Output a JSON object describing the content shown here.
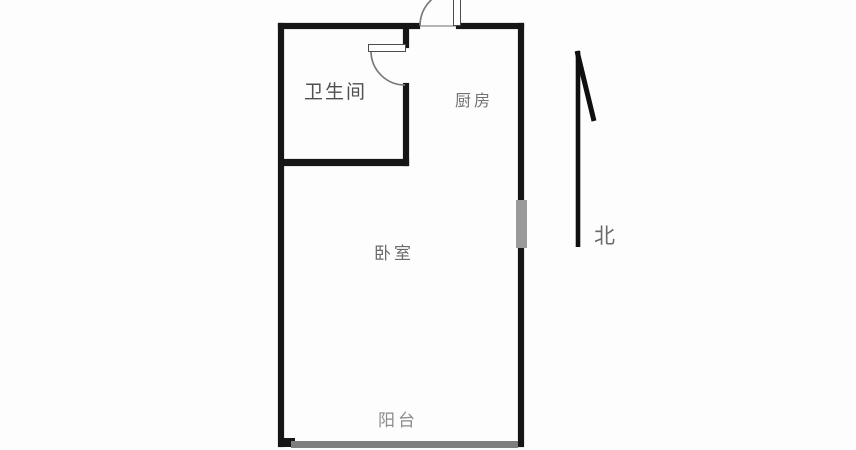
{
  "floorplan": {
    "title": "apartment-floor-plan",
    "rooms": [
      {
        "id": "bathroom",
        "label": "卫生间"
      },
      {
        "id": "kitchen",
        "label": "厨房"
      },
      {
        "id": "bedroom",
        "label": "卧室"
      },
      {
        "id": "balcony",
        "label": "阳台"
      }
    ],
    "compass": {
      "label": "北",
      "direction": "up"
    },
    "features": [
      {
        "id": "entry-door",
        "type": "door",
        "location": "top-wall"
      },
      {
        "id": "bathroom-door",
        "type": "door",
        "location": "bathroom-right-wall"
      },
      {
        "id": "side-window",
        "type": "window",
        "location": "right-wall"
      },
      {
        "id": "balcony-window",
        "type": "window",
        "location": "bottom-wall"
      }
    ],
    "colors": {
      "wall": "#161616",
      "window_marker": "#8f8f8f",
      "label_text": "#6e6e6e",
      "background": "#fdfdfd",
      "door_arc": "#7a7a7a"
    }
  }
}
